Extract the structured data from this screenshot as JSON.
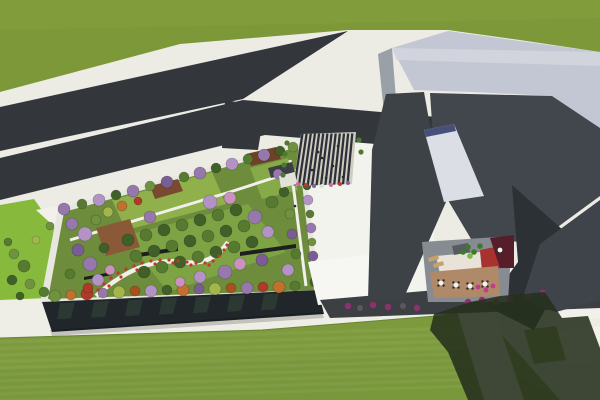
{
  "meta": {
    "title": "Aerial 3D architectural rendering: campus with rooftop garden, road junction, striped entry plaza, angular gray building with courtyard cafe, and large lawns",
    "render_type": "birds-eye 3d visualization"
  },
  "palette": {
    "ground": "#ecebe4",
    "plaza_bright": "#f3f3ee",
    "grass": "#7d9839",
    "grass_light": "#87a23e",
    "road": "#33373c",
    "left_strip": "#86b93c",
    "path_white": "#f1f0ea",
    "sidewalk": "#eeede6",
    "lawn": "#7d9b3d",
    "lawn_overlay": "#75933a",
    "lawn_edge": "#668532",
    "parapet": "#e8e7df",
    "garden_base": "#6d8c3c",
    "lawn_patch_light": "#8fb04a",
    "lawn_patch_mid": "#7da344",
    "lawn_patch_small": "#86aa48",
    "deck_brown": "#7a4a30",
    "deck_brown2": "#6e4226",
    "deck_wood": "#8a5a38",
    "pavilion": "#3c4043",
    "slab": "#1e1e1e",
    "facade_glass": "#20262a",
    "facade_reflect": "#2e3c33",
    "stripe_light": "#cfccc0",
    "stripe_dark": "#2d3038",
    "kiosk": "#e3e2da",
    "hedge": "#4e7a2c",
    "roof_light": "#c3c7d3",
    "roof_bright": "#d4d7e0",
    "wall_left": "#9aa0a8",
    "wing_dark": "#3d4247",
    "facade_dark": "#42474d",
    "wedge": "#2c3136",
    "wing_right": "#3f444a",
    "ramp": "#dcdee6",
    "ramp_top": "#46507a",
    "base_band": "#3c4043",
    "white_structure": "#f6f6f3",
    "court_shadow_floor": "#878c93",
    "court_tan": "#b08968",
    "court_cream": "#e8e2d8",
    "court_red": "#a8322e",
    "court_maroon": "#571e29",
    "skylight": "#565b62",
    "bench": "#c8a06a",
    "table": "#f2f2f2",
    "chair": "#2f2f2f",
    "plant": "#3e7a2a",
    "plant_bright": "#7ab648",
    "shrub_purple": "#8e2f6e",
    "shrub_gray": "#5c565e",
    "shrub_magenta": "#c23a8c",
    "flower_red": "#c0392b",
    "shadow": "#26301d",
    "people": "#2a2a2a"
  },
  "scene": {
    "garden": {
      "tree_palette": [
        "#40602a",
        "#567a30",
        "#6f9240",
        "#9678ad",
        "#b393c6",
        "#c993bb",
        "#c0702f",
        "#a8511f",
        "#a3b54b",
        "#b03a28",
        "#7b5d95",
        "#83933c"
      ],
      "trees": [
        [
          64,
          209,
          6,
          3
        ],
        [
          82,
          204,
          5,
          1
        ],
        [
          99,
          200,
          6,
          4
        ],
        [
          116,
          195,
          5,
          0
        ],
        [
          133,
          191,
          6,
          3
        ],
        [
          150,
          186,
          5,
          2
        ],
        [
          167,
          182,
          6,
          10
        ],
        [
          184,
          177,
          5,
          1
        ],
        [
          200,
          173,
          6,
          3
        ],
        [
          216,
          168,
          5,
          0
        ],
        [
          232,
          164,
          6,
          4
        ],
        [
          248,
          159,
          5,
          1
        ],
        [
          264,
          155,
          6,
          3
        ],
        [
          280,
          151,
          5,
          0
        ],
        [
          293,
          147,
          5,
          2
        ],
        [
          303,
          158,
          4,
          1
        ],
        [
          305,
          172,
          5,
          3
        ],
        [
          307,
          186,
          4,
          0
        ],
        [
          308,
          200,
          5,
          4
        ],
        [
          310,
          214,
          4,
          1
        ],
        [
          311,
          228,
          5,
          3
        ],
        [
          312,
          242,
          4,
          2
        ],
        [
          313,
          256,
          5,
          10
        ],
        [
          314,
          270,
          4,
          1
        ],
        [
          315,
          282,
          5,
          0
        ],
        [
          55,
          296,
          6,
          2
        ],
        [
          71,
          295,
          5,
          6
        ],
        [
          87,
          294,
          6,
          9
        ],
        [
          103,
          293,
          5,
          3
        ],
        [
          119,
          292,
          6,
          8
        ],
        [
          135,
          291,
          5,
          7
        ],
        [
          151,
          291,
          6,
          4
        ],
        [
          167,
          290,
          5,
          0
        ],
        [
          183,
          290,
          6,
          6
        ],
        [
          199,
          289,
          5,
          10
        ],
        [
          215,
          289,
          6,
          8
        ],
        [
          231,
          288,
          5,
          7
        ],
        [
          247,
          288,
          6,
          3
        ],
        [
          263,
          287,
          5,
          9
        ],
        [
          279,
          287,
          6,
          6
        ],
        [
          295,
          286,
          5,
          1
        ],
        [
          72,
          224,
          6,
          3
        ],
        [
          85,
          234,
          7,
          4
        ],
        [
          78,
          250,
          6,
          10
        ],
        [
          90,
          264,
          7,
          3
        ],
        [
          70,
          274,
          5,
          1
        ],
        [
          98,
          280,
          6,
          4
        ],
        [
          110,
          270,
          5,
          5
        ],
        [
          104,
          248,
          5,
          0
        ],
        [
          88,
          288,
          5,
          9
        ],
        [
          128,
          240,
          6,
          0
        ],
        [
          146,
          235,
          6,
          1
        ],
        [
          164,
          230,
          6,
          0
        ],
        [
          182,
          225,
          6,
          1
        ],
        [
          200,
          220,
          6,
          0
        ],
        [
          218,
          215,
          6,
          1
        ],
        [
          236,
          210,
          6,
          0
        ],
        [
          136,
          256,
          6,
          1
        ],
        [
          154,
          251,
          6,
          0
        ],
        [
          172,
          246,
          6,
          1
        ],
        [
          190,
          241,
          6,
          0
        ],
        [
          208,
          236,
          6,
          1
        ],
        [
          226,
          231,
          6,
          0
        ],
        [
          244,
          226,
          6,
          1
        ],
        [
          144,
          272,
          6,
          0
        ],
        [
          162,
          267,
          6,
          1
        ],
        [
          180,
          262,
          6,
          0
        ],
        [
          198,
          257,
          6,
          1
        ],
        [
          216,
          252,
          6,
          0
        ],
        [
          234,
          247,
          6,
          1
        ],
        [
          252,
          242,
          6,
          0
        ],
        [
          210,
          202,
          7,
          4
        ],
        [
          230,
          198,
          6,
          5
        ],
        [
          150,
          217,
          6,
          3
        ],
        [
          255,
          217,
          7,
          3
        ],
        [
          268,
          232,
          6,
          4
        ],
        [
          262,
          260,
          6,
          10
        ],
        [
          240,
          264,
          6,
          5
        ],
        [
          225,
          272,
          7,
          3
        ],
        [
          200,
          277,
          6,
          4
        ],
        [
          180,
          282,
          5,
          5
        ],
        [
          108,
          212,
          5,
          8
        ],
        [
          122,
          206,
          5,
          6
        ],
        [
          138,
          201,
          4,
          9
        ],
        [
          96,
          220,
          5,
          2
        ],
        [
          272,
          202,
          6,
          1
        ],
        [
          284,
          192,
          5,
          0
        ],
        [
          278,
          174,
          5,
          3
        ],
        [
          290,
          214,
          5,
          2
        ],
        [
          292,
          234,
          5,
          10
        ],
        [
          296,
          254,
          5,
          1
        ],
        [
          288,
          270,
          6,
          4
        ]
      ],
      "flowers": [
        [
          98,
          290
        ],
        [
          104,
          284
        ],
        [
          111,
          278
        ],
        [
          118,
          273
        ],
        [
          126,
          269
        ],
        [
          134,
          266
        ],
        [
          142,
          263
        ],
        [
          151,
          261
        ],
        [
          160,
          260
        ],
        [
          169,
          260
        ],
        [
          178,
          261
        ],
        [
          187,
          262
        ],
        [
          196,
          263
        ],
        [
          205,
          263
        ],
        [
          213,
          261
        ],
        [
          219,
          256
        ],
        [
          224,
          250
        ],
        [
          227,
          245
        ],
        [
          109,
          286
        ],
        [
          121,
          277
        ],
        [
          137,
          270
        ],
        [
          155,
          264
        ],
        [
          173,
          263
        ],
        [
          191,
          265
        ],
        [
          209,
          265
        ]
      ]
    },
    "ground_trees": [
      [
        14,
        254,
        5,
        2
      ],
      [
        24,
        266,
        6,
        1
      ],
      [
        12,
        280,
        5,
        0
      ],
      [
        30,
        284,
        5,
        2
      ],
      [
        44,
        292,
        5,
        1
      ],
      [
        8,
        242,
        4,
        1
      ],
      [
        36,
        240,
        4,
        8
      ],
      [
        50,
        226,
        4,
        2
      ],
      [
        20,
        296,
        4,
        0
      ]
    ],
    "plaza": {
      "stripe_count": 13,
      "flowers": [
        [
          298,
          184,
          "#cf6a9e"
        ],
        [
          306,
          185,
          "#c0392b"
        ],
        [
          314,
          186,
          "#8a5fa0"
        ],
        [
          322,
          186,
          "#e0ded2"
        ],
        [
          331,
          185,
          "#cf6a9e"
        ],
        [
          340,
          184,
          "#c0392b"
        ],
        [
          348,
          183,
          "#8a5fa0"
        ]
      ],
      "people": [
        [
          318,
          152
        ],
        [
          333,
          166
        ],
        [
          343,
          177
        ],
        [
          326,
          178
        ],
        [
          312,
          170
        ],
        [
          322,
          158
        ],
        [
          338,
          146
        ]
      ]
    },
    "courtyard": {
      "tables": [
        [
          441,
          283
        ],
        [
          456,
          285
        ],
        [
          470,
          286
        ],
        [
          485,
          284
        ],
        [
          500,
          250
        ]
      ],
      "plants": [
        [
          468,
          247
        ],
        [
          474,
          252
        ],
        [
          480,
          246
        ],
        [
          463,
          252
        ],
        [
          470,
          256
        ]
      ]
    },
    "shrubs": [
      [
        348,
        306,
        "purple"
      ],
      [
        360,
        308,
        "gray"
      ],
      [
        373,
        305,
        "purple"
      ],
      [
        388,
        307,
        "purple"
      ],
      [
        403,
        306,
        "gray"
      ],
      [
        417,
        308,
        "purple"
      ],
      [
        468,
        302,
        "purple"
      ],
      [
        482,
        300,
        "purple"
      ],
      [
        496,
        302,
        "purple"
      ],
      [
        510,
        299,
        "purple"
      ],
      [
        528,
        296,
        "purple"
      ],
      [
        543,
        293,
        "purple"
      ],
      [
        478,
        287,
        "magenta"
      ],
      [
        486,
        290,
        "magenta"
      ],
      [
        493,
        286,
        "magenta"
      ]
    ],
    "people": [
      [
        295,
        206
      ]
    ]
  }
}
